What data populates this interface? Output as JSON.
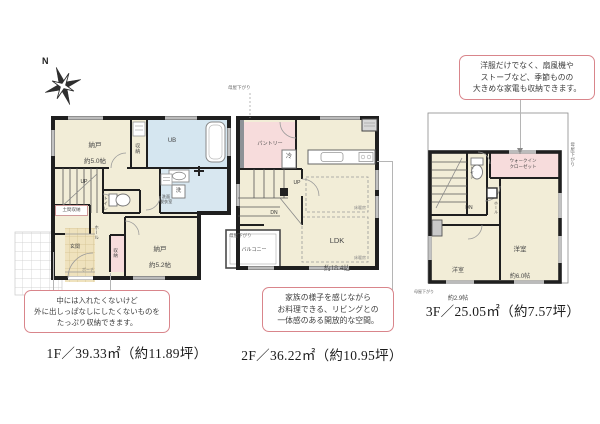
{
  "colors": {
    "wall": "#1f1f1f",
    "room_cream": "#f2edd7",
    "room_blue": "#d5e6f0",
    "room_pink": "#f7dcdc",
    "tile": "#efe2bd",
    "bubble_border": "#d9858b"
  },
  "compass": {
    "north": "N"
  },
  "floor1": {
    "caption": "1F／39.33㎡（約11.89坪）",
    "bubble": "中には入れたくないけど\n外に出しっぱなしにしたくないものを\nたっぷり収納できます。",
    "rooms": {
      "nando_a_name": "納戸",
      "nando_a_size": "約5.0帖",
      "closet_a": "収納",
      "bath": "UB",
      "washroom": "洗面\n脱衣室",
      "washer": "洗",
      "toilet": "トイレ",
      "up": "UP",
      "doma": "土間収納",
      "entrance": "玄関",
      "hall": "ホール",
      "porch": "ポーチ",
      "closet_b": "収納",
      "nando_b_name": "納戸",
      "nando_b_size": "約5.2帖"
    }
  },
  "floor2": {
    "caption": "2F／36.22㎡（約10.95坪）",
    "bubble": "家族の様子を感じながら\nお料理できる、リビングとの\n一体感のある開放的な空間。",
    "rooms": {
      "pantry": "パントリー",
      "fridge": "冷",
      "up": "UP",
      "dn": "DN",
      "ldk_name": "LDK",
      "ldk_size": "約18.4帖",
      "balcony": "バルコニー",
      "floor_heating": "床暖房"
    },
    "notes": {
      "moya_top": "母屋下がり",
      "moya_left": "母屋下がり"
    }
  },
  "floor3": {
    "caption": "3F／25.05㎡（約7.57坪）",
    "bubble": "洋服だけでなく、扇風機や\nストーブなど、季節ものの\n大きめな家電も収納できます。",
    "rooms": {
      "wic": "ウォークイン\nクローゼット",
      "toilet": "トイレ",
      "dn": "DN",
      "hall": "ホール",
      "room_a_name": "洋室",
      "room_a_size": "約6.0帖",
      "room_b_name": "洋室",
      "room_b_size": "約2.9帖"
    },
    "notes": {
      "moya_right": "母屋下がり",
      "moya_bottom": "母屋下がり"
    }
  }
}
